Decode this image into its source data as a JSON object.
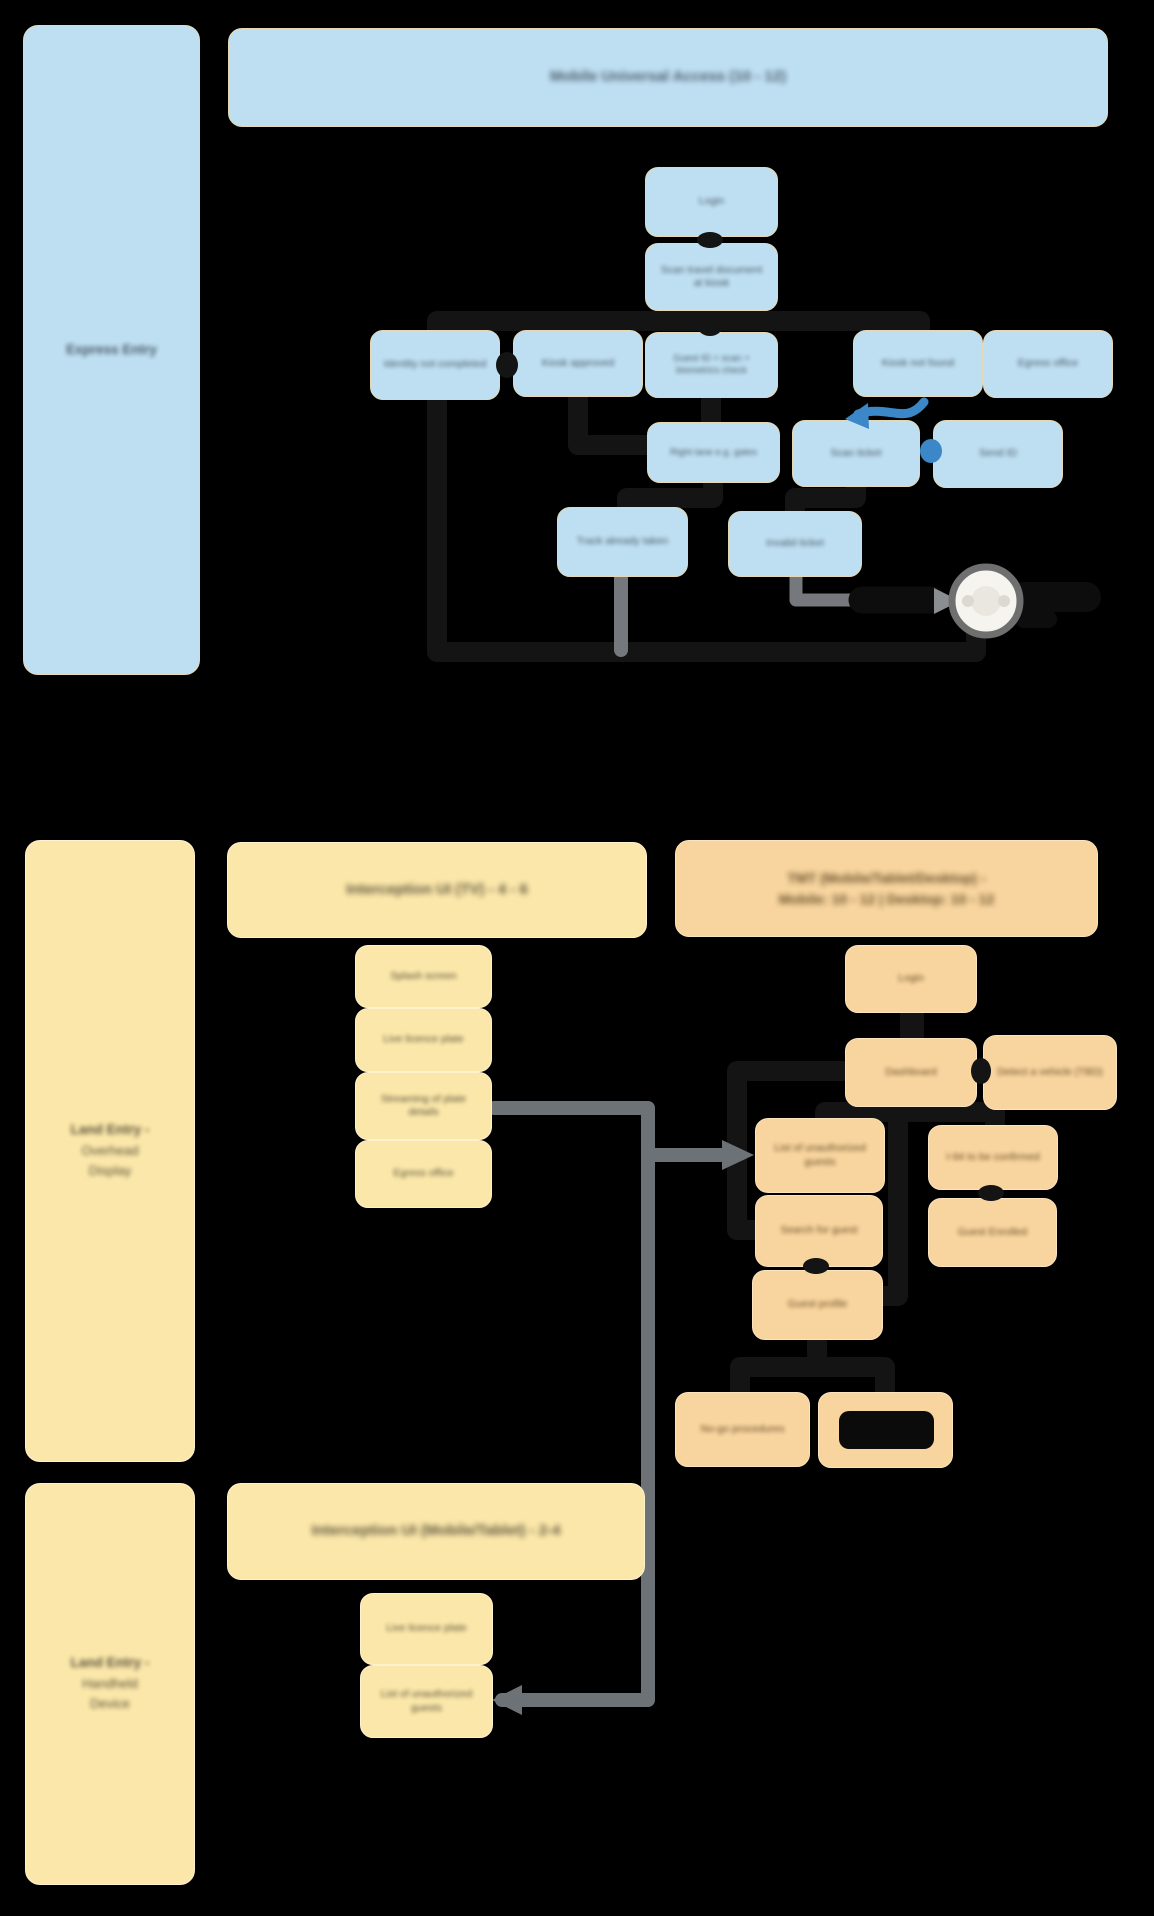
{
  "palette": {
    "background": "#000000",
    "blue_fill": "#bedff2",
    "yellow_fill": "#fbe7a9",
    "orange_fill": "#f8d49e",
    "connector_black": "#141414",
    "connector_gray": "#6d7276",
    "accent_blue": "#3b87c8",
    "end_node_fill": "#f6f4ee"
  },
  "express": {
    "sidebar_label": "Express Entry",
    "header": "Mobile Universal Access (10 - 12)",
    "nodes": {
      "login": "Login",
      "scan_doc": "Scan travel document at kiosk",
      "identity_not_completed": "Identity not completed",
      "kiosk_approved": "Kiosk approved",
      "guest_id": "Guest ID + scan + biometrics check",
      "kiosk_not_found": "Kiosk not found",
      "egress_office": "Egress office",
      "right_lane": "Right lane e.g. gates",
      "scan_ticket": "Scan ticket",
      "send_id": "Send ID",
      "track_taken": "Track already taken",
      "invalid_ticket": "Invalid ticket"
    }
  },
  "overhead": {
    "sidebar_title": "Land Entry -",
    "sidebar_subtitle": "Overhead Display",
    "tv_header": "Interception UI (TV) - 4 - 6",
    "tmt_header_line1": "TMT (Mobile/Tablet/Desktop) -",
    "tmt_header_line2": "Mobile: 10 - 12   |   Desktop: 10 - 12",
    "tv_nodes": {
      "splash": "Splash screen",
      "live_plate": "Live licence plate",
      "streaming": "Streaming of plate details",
      "egress_office": "Egress office"
    },
    "tmt_nodes": {
      "login": "Login",
      "dashboard": "Dashboard",
      "detect_vehicle": "Detect a vehicle (TBD)",
      "unauthorized_list": "List of unauthorized guests",
      "i94": "I-94 to be confirmed",
      "guest_enrolled": "Guest Enrolled",
      "search_guest": "Search for guest",
      "guest_profile": "Guest profile",
      "no_go": "No-go procedures",
      "redacted": ""
    }
  },
  "handheld": {
    "sidebar_title": "Land Entry -",
    "sidebar_subtitle": "Handheld Device",
    "header": "Interception UI (Mobile/Tablet) - 2-4",
    "nodes": {
      "live_plate": "Live licence plate",
      "unauthorized_list": "List of unauthorized guests"
    }
  }
}
